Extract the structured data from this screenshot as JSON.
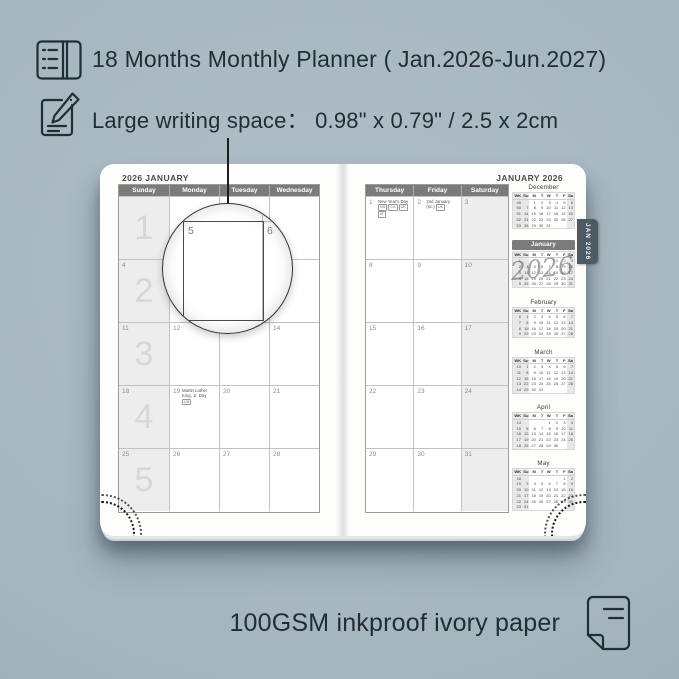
{
  "colors": {
    "background": "#a5b5be",
    "ink": "#222d36",
    "calendar_header_bar": "#7b7b7b",
    "weekend_fill": "#ededed",
    "tab_fill": "#4d5a62",
    "page_fill": "#fdfdfc"
  },
  "features": [
    {
      "icon": "open-planner-icon",
      "text": "18 Months Monthly Planner ( Jan.2026-Jun.2027)"
    },
    {
      "icon": "writing-pencil-icon",
      "text": "Large writing space：  0.98\" x 0.79\" / 2.5 x 2cm"
    }
  ],
  "magnifier": {
    "left_value": "5",
    "right_value": "6"
  },
  "planner": {
    "tab_label": "JAN 2026",
    "watermark": "2026",
    "left_page": {
      "title": "2026 JANUARY",
      "day_headers": [
        "Sunday",
        "Monday",
        "Tuesday",
        "Wednesday"
      ],
      "shaded_col": 0,
      "weeks": [
        {
          "big": "1",
          "cells": [
            {
              "d": ""
            },
            {
              "d": ""
            },
            {
              "d": ""
            },
            {
              "d": ""
            }
          ]
        },
        {
          "big": "2",
          "cells": [
            {
              "d": "4"
            },
            {
              "d": "5"
            },
            {
              "d": "6"
            },
            {
              "d": "7"
            }
          ]
        },
        {
          "big": "3",
          "cells": [
            {
              "d": "11"
            },
            {
              "d": "12"
            },
            {
              "d": "13"
            },
            {
              "d": "14"
            }
          ]
        },
        {
          "big": "4",
          "cells": [
            {
              "d": "18"
            },
            {
              "d": "19",
              "holiday": "Martin Luther King, Jr. Day",
              "badges": [
                "US"
              ]
            },
            {
              "d": "20"
            },
            {
              "d": "21"
            }
          ]
        },
        {
          "big": "5",
          "cells": [
            {
              "d": "25"
            },
            {
              "d": "26"
            },
            {
              "d": "27"
            },
            {
              "d": "28"
            }
          ]
        }
      ]
    },
    "right_page": {
      "title": "JANUARY 2026",
      "day_headers": [
        "Thursday",
        "Friday",
        "Saturday"
      ],
      "shaded_col": 2,
      "weeks": [
        {
          "cells": [
            {
              "d": "1",
              "holiday": "New Year's Day",
              "badges": [
                "US",
                "CA",
                "UK",
                "IE"
              ]
            },
            {
              "d": "2",
              "holiday": "2nd January (sc.)",
              "badges": [
                "UK"
              ]
            },
            {
              "d": "3"
            }
          ]
        },
        {
          "cells": [
            {
              "d": "8"
            },
            {
              "d": "9"
            },
            {
              "d": "10"
            }
          ]
        },
        {
          "cells": [
            {
              "d": "15"
            },
            {
              "d": "16"
            },
            {
              "d": "17"
            }
          ]
        },
        {
          "cells": [
            {
              "d": "22"
            },
            {
              "d": "23"
            },
            {
              "d": "24"
            }
          ]
        },
        {
          "cells": [
            {
              "d": "29"
            },
            {
              "d": "30"
            },
            {
              "d": "31"
            }
          ]
        }
      ]
    },
    "mini_sidebar": {
      "day_header": [
        "WK",
        "Su",
        "M",
        "T",
        "W",
        "T",
        "F",
        "Sa"
      ],
      "months": [
        {
          "name": "December",
          "highlight": false,
          "rows": [
            [
              "49",
              "",
              "1",
              "2",
              "3",
              "4",
              "5",
              "6"
            ],
            [
              "50",
              "7",
              "8",
              "9",
              "10",
              "11",
              "12",
              "13"
            ],
            [
              "51",
              "14",
              "15",
              "16",
              "17",
              "18",
              "19",
              "20"
            ],
            [
              "52",
              "21",
              "22",
              "23",
              "24",
              "25",
              "26",
              "27"
            ],
            [
              "53",
              "28",
              "29",
              "30",
              "31",
              "",
              "",
              ""
            ]
          ]
        },
        {
          "name": "January",
          "highlight": true,
          "rows": [
            [
              "1",
              "",
              "",
              "",
              "",
              "1",
              "2",
              "3"
            ],
            [
              "2",
              "4",
              "5",
              "6",
              "7",
              "8",
              "9",
              "10"
            ],
            [
              "3",
              "11",
              "12",
              "13",
              "14",
              "15",
              "16",
              "17"
            ],
            [
              "4",
              "18",
              "19",
              "20",
              "21",
              "22",
              "23",
              "24"
            ],
            [
              "5",
              "25",
              "26",
              "27",
              "28",
              "29",
              "30",
              "31"
            ]
          ]
        },
        {
          "name": "February",
          "highlight": false,
          "rows": [
            [
              "6",
              "1",
              "2",
              "3",
              "4",
              "5",
              "6",
              "7"
            ],
            [
              "7",
              "8",
              "9",
              "10",
              "11",
              "12",
              "13",
              "14"
            ],
            [
              "8",
              "15",
              "16",
              "17",
              "18",
              "19",
              "20",
              "21"
            ],
            [
              "9",
              "22",
              "23",
              "24",
              "25",
              "26",
              "27",
              "28"
            ]
          ]
        },
        {
          "name": "March",
          "highlight": false,
          "rows": [
            [
              "10",
              "1",
              "2",
              "3",
              "4",
              "5",
              "6",
              "7"
            ],
            [
              "11",
              "8",
              "9",
              "10",
              "11",
              "12",
              "13",
              "14"
            ],
            [
              "12",
              "15",
              "16",
              "17",
              "18",
              "19",
              "20",
              "21"
            ],
            [
              "13",
              "22",
              "23",
              "24",
              "25",
              "26",
              "27",
              "28"
            ],
            [
              "14",
              "29",
              "30",
              "31",
              "",
              "",
              "",
              ""
            ]
          ]
        },
        {
          "name": "April",
          "highlight": false,
          "rows": [
            [
              "14",
              "",
              "",
              "",
              "1",
              "2",
              "3",
              "4"
            ],
            [
              "15",
              "5",
              "6",
              "7",
              "8",
              "9",
              "10",
              "11"
            ],
            [
              "16",
              "12",
              "13",
              "14",
              "15",
              "16",
              "17",
              "18"
            ],
            [
              "17",
              "19",
              "20",
              "21",
              "22",
              "23",
              "24",
              "25"
            ],
            [
              "18",
              "26",
              "27",
              "28",
              "29",
              "30",
              "",
              ""
            ]
          ]
        },
        {
          "name": "May",
          "highlight": false,
          "rows": [
            [
              "18",
              "",
              "",
              "",
              "",
              "",
              "1",
              "2"
            ],
            [
              "19",
              "3",
              "4",
              "5",
              "6",
              "7",
              "8",
              "9"
            ],
            [
              "20",
              "10",
              "11",
              "12",
              "13",
              "14",
              "15",
              "16"
            ],
            [
              "21",
              "17",
              "18",
              "19",
              "20",
              "21",
              "22",
              "23"
            ],
            [
              "22",
              "24",
              "25",
              "26",
              "27",
              "28",
              "29",
              "30"
            ],
            [
              "23",
              "31",
              "",
              "",
              "",
              "",
              "",
              ""
            ]
          ]
        }
      ]
    }
  },
  "footer": {
    "icon": "paper-sheet-icon",
    "text": "100GSM inkproof ivory paper"
  }
}
